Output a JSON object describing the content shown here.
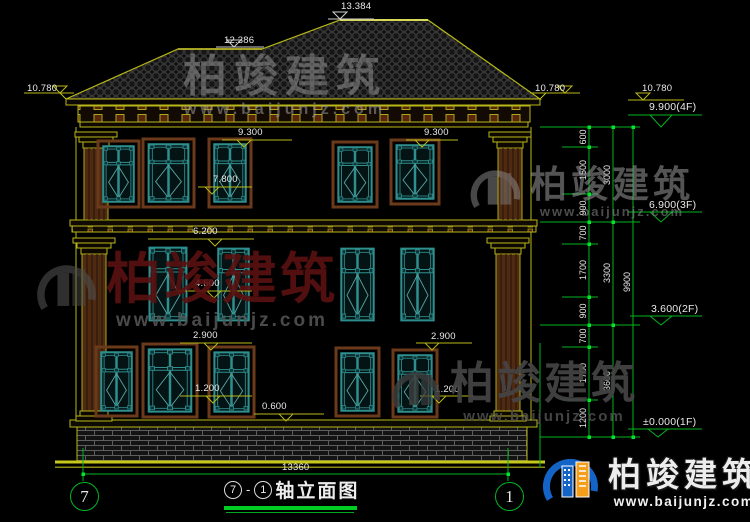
{
  "brand": {
    "name": "柏竣建筑",
    "site": "www.baijunjz.com"
  },
  "title": {
    "axis_left": "7",
    "separator": "-",
    "axis_right": "1",
    "name": "轴立面图"
  },
  "axis_bubbles": {
    "left": "7",
    "right": "1"
  },
  "levels": {
    "ridge": "13.384",
    "ridge2": "12.386",
    "eave_left": "10.780",
    "eave_right_a": "10.780",
    "eave_right_b": "10.780",
    "floor4": "9.900(4F)",
    "floor3": "6.900(3F)",
    "floor2": "3.600(2F)",
    "floor1": "±0.000(1F)",
    "win3_top_a": "9.300",
    "win3_top_b": "9.300",
    "win3_sill": "7.800",
    "win2_top": "6.200",
    "win2_sill": "4.500",
    "win1_top_a": "2.900",
    "win1_top_b": "2.900",
    "win1_sill_a": "1.200",
    "win1_sill_b": "1.200",
    "plinth": "0.600"
  },
  "dims": {
    "overall": "13360",
    "segments": [
      "600",
      "1500",
      "900",
      "700",
      "1700",
      "900",
      "700",
      "1700",
      "1200"
    ],
    "floors": [
      "3000",
      "3300",
      "3600"
    ],
    "total": "9900"
  }
}
